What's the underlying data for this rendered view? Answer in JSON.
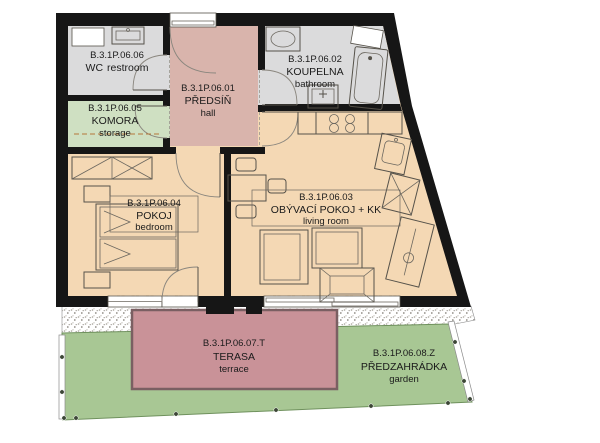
{
  "floorplan": {
    "rooms": {
      "hall": {
        "code": "B.3.1P.06.01",
        "name": "PŘEDSÍŇ",
        "name_en": "hall",
        "color": "#d9b4ac"
      },
      "bathroom": {
        "code": "B.3.1P.06.02",
        "name": "KOUPELNA",
        "name_en": "bathroom",
        "color": "#dbdbdc"
      },
      "living_room": {
        "code": "B.3.1P.06.03",
        "name": "OBÝVACÍ POKOJ + KK",
        "name_en": "living room",
        "color": "#f4d8b4"
      },
      "bedroom": {
        "code": "B.3.1P.06.04",
        "name": "POKOJ",
        "name_en": "bedroom",
        "color": "#f4d8b4"
      },
      "storage": {
        "code": "B.3.1P.06.05",
        "name": "KOMORA",
        "name_en": "storage",
        "color": "#cfe0c2"
      },
      "wc": {
        "code": "B.3.1P.06.06",
        "name": "WC",
        "name_en": "restroom",
        "color": "#dbdbdc"
      },
      "terrace": {
        "code": "B.3.1P.06.07.T",
        "name": "TERASA",
        "name_en": "terrace",
        "color": "#c99298"
      },
      "garden": {
        "code": "B.3.1P.06.08.Z",
        "name": "PŘEDZAHRÁDKA",
        "name_en": "garden",
        "color": "#a8c794"
      }
    },
    "colors": {
      "wall": "#161616",
      "floor_tan": "#f4d8b4",
      "terrace_border": "#7a5f62",
      "garden_border": "#6f915d",
      "background": "#ffffff"
    }
  }
}
